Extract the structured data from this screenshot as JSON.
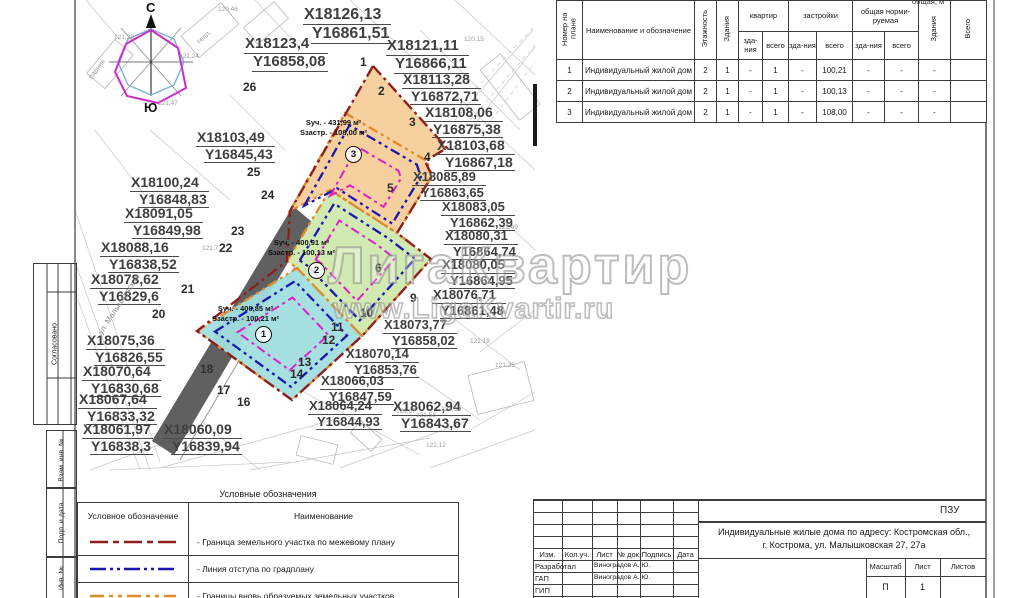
{
  "map": {
    "compass": {
      "north": "С",
      "south": "Ю"
    },
    "street_label": "ул. Малышковская",
    "watermark": {
      "line1": "ЛигаКвартир",
      "line2": "www.LigaKvartir.ru"
    },
    "parcels": [
      {
        "number": "1",
        "area_label": "Sуч. - 400,85 м²",
        "built_label": "Sзастр. - 100,21 м²"
      },
      {
        "number": "2",
        "area_label": "Sуч. - 400,91 м²",
        "built_label": "Sзастр. - 100,13 м²"
      },
      {
        "number": "3",
        "area_label": "Sуч. - 431,99 м²",
        "built_label": "Sзастр. - 108,00 м²"
      }
    ],
    "colors": {
      "parcel1_fill": "#a2dede",
      "parcel2_fill": "#cfe9ad",
      "parcel3_fill": "#f6cd99",
      "site_boundary": "#8e1f1f",
      "setback_line": "#1818b0",
      "new_parcel_line": "#e08a28",
      "inner_line": "#de1fc8",
      "road_fill": "#4a4a4a"
    },
    "coordinate_labels": [
      {
        "x": 303,
        "y": 6,
        "X": "X18126,13",
        "Y": "Y16861,51",
        "s": 16
      },
      {
        "x": 244,
        "y": 36,
        "X": "X18123,4",
        "Y": "Y16858,08",
        "s": 15
      },
      {
        "x": 386,
        "y": 38,
        "X": "X18121,11",
        "Y": "Y16866,11",
        "s": 15
      },
      {
        "x": 402,
        "y": 72,
        "X": "X18113,28",
        "Y": "Y16872,71",
        "s": 14
      },
      {
        "x": 424,
        "y": 105,
        "X": "X18108,06",
        "Y": "Y16875,38",
        "s": 14
      },
      {
        "x": 436,
        "y": 138,
        "X": "X18103,68",
        "Y": "Y16867,18",
        "s": 14
      },
      {
        "x": 412,
        "y": 170,
        "X": "X18085,89",
        "Y": "Y16863,65",
        "s": 13
      },
      {
        "x": 441,
        "y": 200,
        "X": "X18083,05",
        "Y": "Y16862,39",
        "s": 13
      },
      {
        "x": 444,
        "y": 229,
        "X": "X18080,31",
        "Y": "Y16864,74",
        "s": 13
      },
      {
        "x": 441,
        "y": 258,
        "X": "X18080,05",
        "Y": "Y16864,95",
        "s": 13
      },
      {
        "x": 432,
        "y": 288,
        "X": "X18076,71",
        "Y": "Y16861,48",
        "s": 13
      },
      {
        "x": 383,
        "y": 318,
        "X": "X18073,77",
        "Y": "Y16858,02",
        "s": 13
      },
      {
        "x": 345,
        "y": 347,
        "X": "X18070,14",
        "Y": "Y16853,76",
        "s": 13
      },
      {
        "x": 320,
        "y": 374,
        "X": "X18066,03",
        "Y": "Y16847,59",
        "s": 13
      },
      {
        "x": 308,
        "y": 399,
        "X": "X18064,24",
        "Y": "Y16844,93",
        "s": 13
      },
      {
        "x": 392,
        "y": 399,
        "X": "X18062,94",
        "Y": "Y16843,67",
        "s": 14
      },
      {
        "x": 196,
        "y": 130,
        "X": "X18103,49",
        "Y": "Y16845,43",
        "s": 14
      },
      {
        "x": 130,
        "y": 175,
        "X": "X18100,24",
        "Y": "Y16848,83",
        "s": 14
      },
      {
        "x": 124,
        "y": 206,
        "X": "X18091,05",
        "Y": "Y16849,98",
        "s": 14
      },
      {
        "x": 100,
        "y": 240,
        "X": "X18088,16",
        "Y": "Y16838,52",
        "s": 14
      },
      {
        "x": 90,
        "y": 272,
        "X": "X18078,62",
        "Y": "Y16829,6",
        "s": 14
      },
      {
        "x": 86,
        "y": 333,
        "X": "X18075,36",
        "Y": "Y16826,55",
        "s": 14
      },
      {
        "x": 82,
        "y": 364,
        "X": "X18070,64",
        "Y": "Y16830,68",
        "s": 14
      },
      {
        "x": 78,
        "y": 392,
        "X": "X18067,64",
        "Y": "Y16833,32",
        "s": 14
      },
      {
        "x": 82,
        "y": 422,
        "X": "X18061,97",
        "Y": "Y16838,3",
        "s": 14
      },
      {
        "x": 163,
        "y": 422,
        "X": "X18060,09",
        "Y": "Y16839,94",
        "s": 14
      }
    ],
    "point_numbers": [
      {
        "n": "26",
        "x": 243,
        "y": 80
      },
      {
        "n": "1",
        "x": 360,
        "y": 55
      },
      {
        "n": "2",
        "x": 378,
        "y": 84
      },
      {
        "n": "3",
        "x": 409,
        "y": 115
      },
      {
        "n": "4",
        "x": 424,
        "y": 150
      },
      {
        "n": "5",
        "x": 387,
        "y": 181
      },
      {
        "n": "6",
        "x": 375,
        "y": 261
      },
      {
        "n": "9",
        "x": 410,
        "y": 291
      },
      {
        "n": "10",
        "x": 360,
        "y": 306
      },
      {
        "n": "11",
        "x": 331,
        "y": 320
      },
      {
        "n": "12",
        "x": 322,
        "y": 333
      },
      {
        "n": "13",
        "x": 298,
        "y": 355
      },
      {
        "n": "14",
        "x": 290,
        "y": 367
      },
      {
        "n": "16",
        "x": 237,
        "y": 395
      },
      {
        "n": "17",
        "x": 217,
        "y": 383
      },
      {
        "n": "18",
        "x": 200,
        "y": 362
      },
      {
        "n": "20",
        "x": 152,
        "y": 307
      },
      {
        "n": "21",
        "x": 181,
        "y": 282
      },
      {
        "n": "22",
        "x": 219,
        "y": 241
      },
      {
        "n": "23",
        "x": 231,
        "y": 224
      },
      {
        "n": "24",
        "x": 261,
        "y": 188
      },
      {
        "n": "25",
        "x": 247,
        "y": 165
      }
    ],
    "elevations": [
      {
        "v": "120,46",
        "x": 218,
        "y": 6
      },
      {
        "v": "121,28",
        "x": 114,
        "y": 34
      },
      {
        "v": "121,24",
        "x": 179,
        "y": 53
      },
      {
        "v": "121,47",
        "x": 158,
        "y": 100
      },
      {
        "v": "120,15",
        "x": 464,
        "y": 36
      },
      {
        "v": "122,49",
        "x": 498,
        "y": 224
      },
      {
        "v": "121,18",
        "x": 470,
        "y": 338
      },
      {
        "v": "121,35",
        "x": 495,
        "y": 362
      },
      {
        "v": "122,12",
        "x": 426,
        "y": 442
      },
      {
        "v": "121,67",
        "x": 396,
        "y": 408
      },
      {
        "v": "121,58",
        "x": 416,
        "y": 412
      },
      {
        "v": "121,33",
        "x": 441,
        "y": 406
      },
      {
        "v": "121,7",
        "x": 202,
        "y": 245
      }
    ],
    "building_labels": [
      {
        "t": "тепл.",
        "x": 196,
        "y": 34,
        "r": -42
      },
      {
        "t": "парник",
        "x": 86,
        "y": 66,
        "r": -52
      }
    ]
  },
  "summary_table": {
    "top_partial": "общая, м",
    "columns": {
      "num": "Номер на плане",
      "name": "Наименование и обозначение",
      "floors": "Этажность",
      "bldgs": "Здания",
      "groups": [
        {
          "label": "квартир",
          "subs": [
            "зда-\nния",
            "всего"
          ]
        },
        {
          "label": "застройки",
          "subs": [
            "зда-\nния",
            "всего"
          ]
        },
        {
          "label": "общая норми-\nруемая",
          "subs": [
            "зда-\nния",
            "всего"
          ]
        }
      ],
      "bldgs2": "Здания",
      "total": "Всего"
    },
    "rows": [
      [
        "1",
        "Индивидуальный жилой дом",
        "2",
        "1",
        "-",
        "1",
        "-",
        "100,21",
        "-",
        "-",
        "-",
        ""
      ],
      [
        "2",
        "Индивидуальный жилой дом",
        "2",
        "1",
        "-",
        "1",
        "-",
        "100,13",
        "-",
        "-",
        "-",
        ""
      ],
      [
        "3",
        "Индивидуальный жилой дом",
        "2",
        "1",
        "-",
        "1",
        "-",
        "108,00",
        "-",
        "-",
        "-",
        ""
      ]
    ]
  },
  "legend": {
    "title": "Условные обозначения",
    "col1_header": "Условное обозначение",
    "col2_header": "Наименование",
    "rows": [
      {
        "color": "#8e1f1f",
        "dash": "18 5 6 5",
        "label": "- Граница земельного участка по межевому плану"
      },
      {
        "color": "#1818b0",
        "dash": "16 4 3 4 3 4",
        "label": "- Линия отступа по градплану"
      },
      {
        "color": "#e08a28",
        "dash": "14 5 4 5 4 5",
        "label": "- Границы вновь образуемых земельных участков"
      }
    ]
  },
  "title_block": {
    "code": "ПЗУ",
    "title_line1": "Индивидуальные жилые дома по адресу: Костромская обл.,",
    "title_line2": "г. Кострома, ул. Малышковская 27, 27а",
    "header_cells": [
      "Изм.",
      "Кол.уч.",
      "Лист",
      "№ док.",
      "Подпись",
      "Дата"
    ],
    "rows": [
      {
        "role": "Разработал",
        "name": "Виноградов А. Ю."
      },
      {
        "role": "ГАП",
        "name": "Виноградов А. Ю."
      },
      {
        "role": "ГИП",
        "name": ""
      }
    ],
    "scale_header": "Масштаб",
    "sheet_header": "Лист",
    "sheets_header": "Листов",
    "scale_value": "П",
    "sheet_value": "1",
    "sheets_value": ""
  },
  "margin_labels": [
    "Согласовано",
    "Взам. инв. №",
    "Подп. и дата",
    "Инв. №"
  ]
}
